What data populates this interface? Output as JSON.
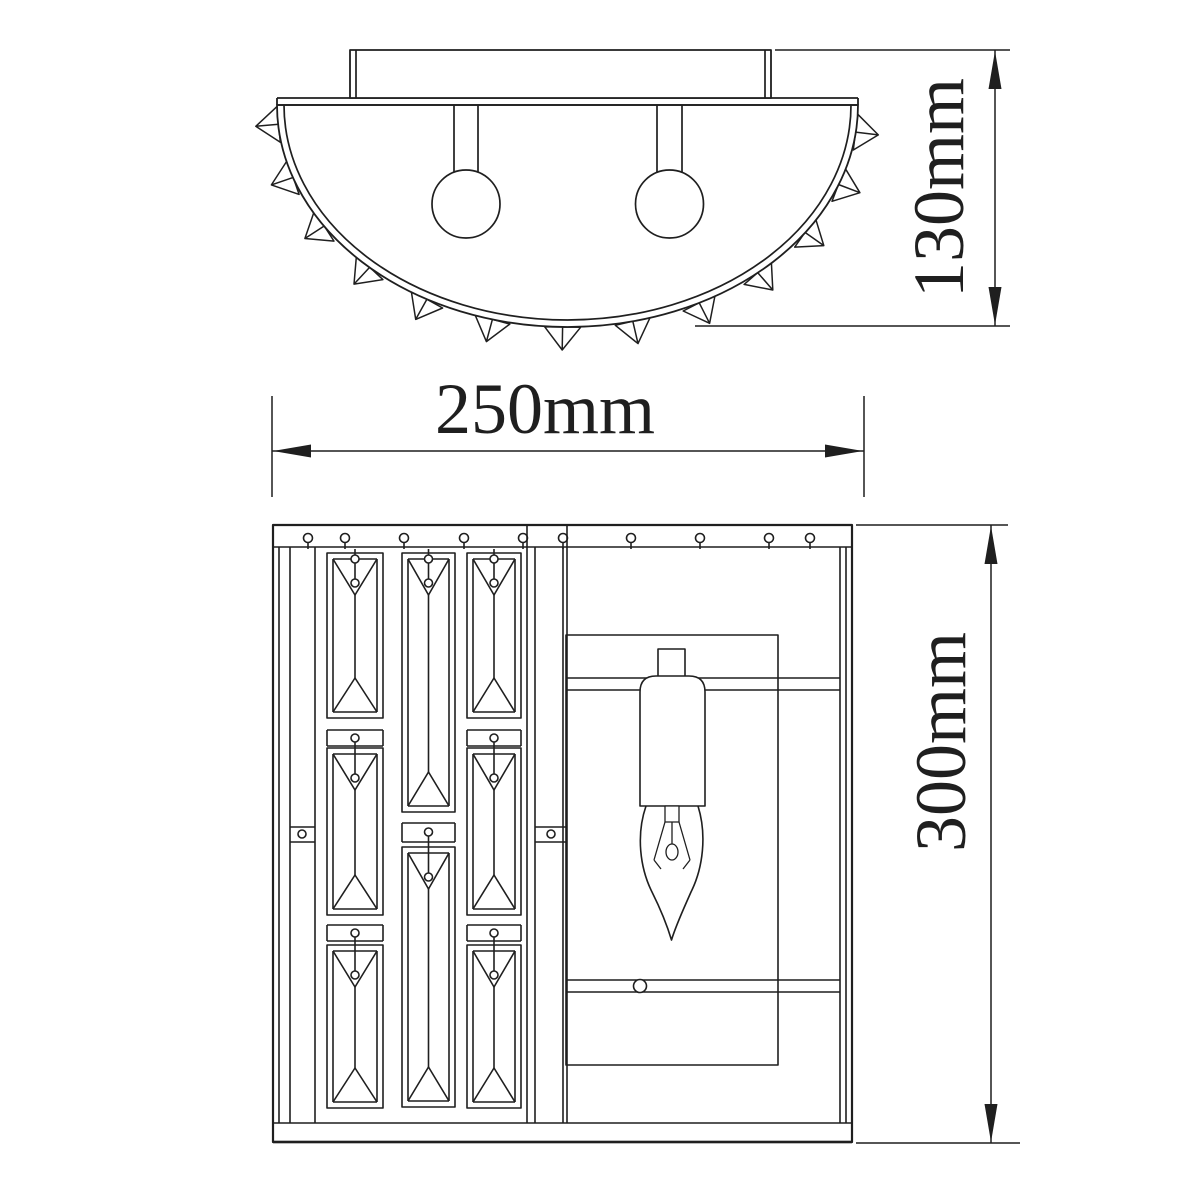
{
  "drawing": {
    "title": "wall-sconce-dimension-drawing",
    "background": "#ffffff",
    "line_color": "#1f1f1f",
    "dimensions": {
      "width_label": "250mm",
      "top_view_height_label": "130mm",
      "front_view_height_label": "300mm"
    }
  }
}
